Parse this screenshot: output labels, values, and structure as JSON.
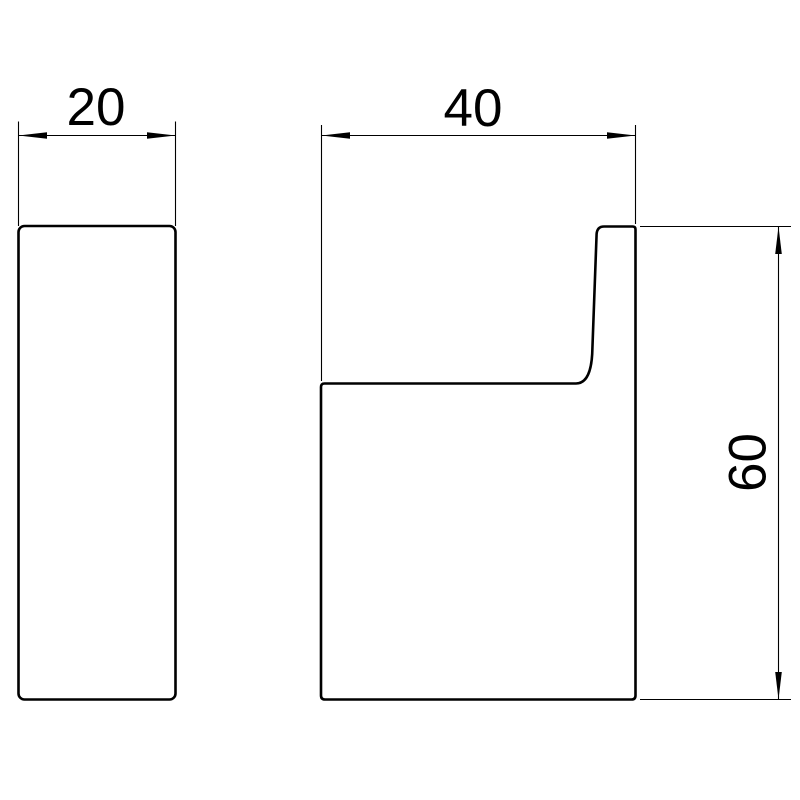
{
  "drawing": {
    "kind": "technical dimension drawing",
    "background_color": "#ffffff",
    "line_color": "#000000",
    "views": {
      "side_view": {
        "name": "side-view-plate"
      },
      "profile_view": {
        "name": "hook-profile-view"
      }
    },
    "dimensions": {
      "side_width": {
        "label": "20"
      },
      "projection": {
        "label": "40"
      },
      "height": {
        "label": "60"
      }
    }
  }
}
